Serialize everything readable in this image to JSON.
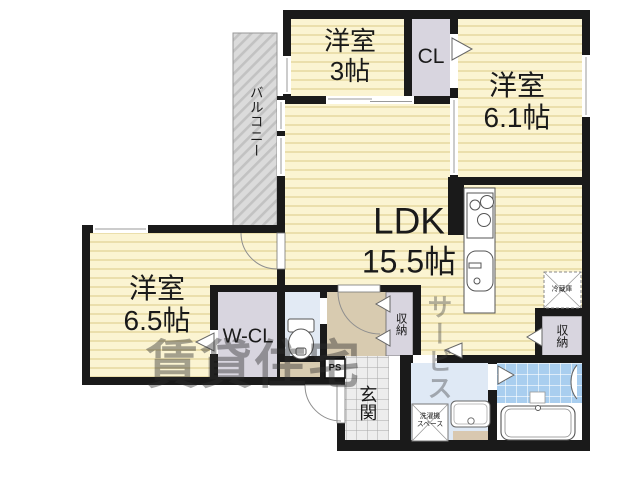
{
  "balcony": {
    "label": "バルコニー"
  },
  "rooms": {
    "bedroom_top": {
      "name": "洋室",
      "size": "3帖"
    },
    "bedroom_right": {
      "name": "洋室",
      "size": "6.1帖"
    },
    "bedroom_left": {
      "name": "洋室",
      "size": "6.5帖"
    },
    "ldk": {
      "name": "LDK",
      "size": "15.5帖"
    }
  },
  "storage": {
    "cl": "CL",
    "wcl": "W-CL",
    "hall_storage": "収納",
    "kitchen_storage": "収納"
  },
  "fixtures": {
    "genkan": "玄関",
    "ps": "PS",
    "fridge": "冷蔵庫",
    "washer_line1": "洗濯機",
    "washer_line2": "スペース"
  },
  "watermark": {
    "block_text": "賃貸住宅",
    "vertical_text": "サービス"
  },
  "colors": {
    "wall": "#1A1A1A",
    "room_fill": "#FBF4D2",
    "room_stripe": "#EBDFAC",
    "closet_fill": "#D8D5DF",
    "hallway_fill": "#D8CBB0",
    "wet_room_fill": "#DFE9F5",
    "bath_tile": "#A9CEEF",
    "balcony_fill": "#DBDBDB",
    "genkan_tile": "#EDEDED"
  }
}
